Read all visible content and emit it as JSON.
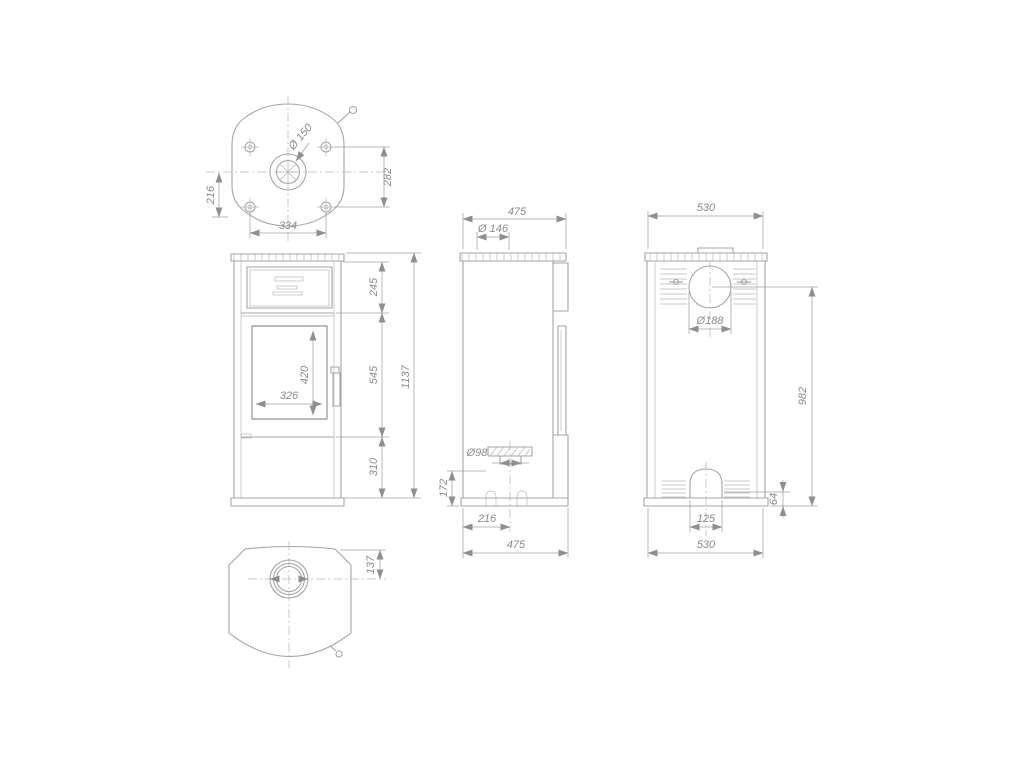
{
  "drawing": {
    "type": "technical-orthographic-views",
    "subject": "free-standing stove dimensional drawing",
    "units_implied": "mm",
    "colors": {
      "background": "#ffffff",
      "line": "#a4a4a4",
      "text": "#8a8a8a"
    },
    "views": {
      "top": {
        "flue_diameter": "Ø 150",
        "center_to_rear": "216",
        "bolt_depth": "282",
        "bolt_width": "334"
      },
      "front": {
        "top_section": "245",
        "middle_section": "545",
        "base_section": "310",
        "total_height": "1137",
        "glass_height": "420",
        "glass_width": "326"
      },
      "side": {
        "depth_top": "475",
        "flue_collar": "Ø 146",
        "air_inlet": "Ø98",
        "inlet_height": "172",
        "inlet_offset": "216",
        "depth_bottom": "475"
      },
      "rear": {
        "width_top": "530",
        "outlet_diameter": "Ø188",
        "outlet_center_height": "982",
        "plinth_height": "64",
        "arch_width": "125",
        "width_bottom": "530"
      },
      "bottom": {
        "flue_offset": "137"
      }
    }
  }
}
